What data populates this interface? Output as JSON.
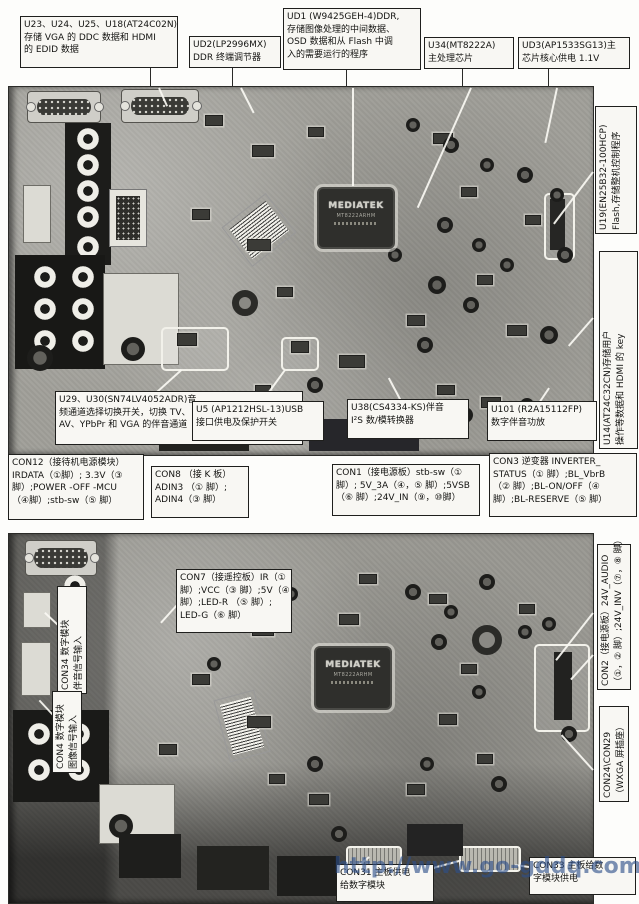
{
  "chip": {
    "logo": "MEDIATEK",
    "line1": "MT8222ARHM"
  },
  "watermark": {
    "text": "http://www.go-gddq.com",
    "color": "#2d4f8a"
  },
  "callouts": {
    "u23": {
      "lines": [
        "U23、U24、U25、U18(AT24C02N)",
        "存储 VGA 的 DDC 数据和 HDMI",
        "的 EDID 数据"
      ]
    },
    "ud2": {
      "lines": [
        "UD2(LP2996MX)",
        "DDR 终端调节器"
      ]
    },
    "ud1": {
      "lines": [
        "UD1 (W9425GEH-4)DDR,",
        "存储图像处理的中间数据、",
        "OSD 数据和从 Flash 中调",
        "入的需要运行的程序"
      ]
    },
    "u34": {
      "lines": [
        "U34(MT8222A)",
        "主处理芯片"
      ]
    },
    "ud3": {
      "lines": [
        "UD3(AP1533SG13)主",
        "芯片核心供电 1.1V"
      ]
    },
    "u19": {
      "lines": [
        "U19(EN25B32-100HCP)",
        "Flash,存储整机控制程序"
      ]
    },
    "u14": {
      "lines": [
        "U14(AT24C32CN)存储用户",
        "操作等数据和 HDMI 的 key"
      ]
    },
    "u29": {
      "lines": [
        "U29、U30(SN74LV4052ADR)音",
        "频通道选择切换开关，切换 TV、",
        "AV、YPbPr 和 VGA 的伴音通道"
      ]
    },
    "u5": {
      "lines": [
        "U5 (AP1212HSL-13)USB",
        "接口供电及保护开关"
      ]
    },
    "u38": {
      "lines": [
        "U38(CS4334-KS)伴音",
        "I²S 数/模转换器"
      ]
    },
    "u101": {
      "lines": [
        "U101 (R2A15112FP)",
        "数字伴音功放"
      ]
    },
    "con12": {
      "lines": [
        "CON12（接待机电源模块）",
        "IRDATA（①脚）; 3.3V（③",
        "脚）;POWER -OFF -MCU",
        "（④脚）;stb-sw（⑤ 脚）"
      ]
    },
    "con8": {
      "lines": [
        "CON8 （接 K 板）",
        "ADIN3 （① 脚）;",
        "ADIN4（③ 脚）"
      ]
    },
    "con1": {
      "lines": [
        "CON1（接电源板）stb-sw（①",
        "脚）; 5V_3A（④，⑤ 脚）;5VSB",
        "（⑥ 脚）;24V_IN（⑨，⑩脚）"
      ]
    },
    "con3": {
      "lines": [
        "CON3 逆变器 INVERTER_",
        "STATUS（① 脚）;BL_VbrB",
        "（② 脚）;BL-ON/OFF（④",
        "脚）;BL-RESERVE（⑤ 脚）"
      ]
    },
    "con34": {
      "lines": [
        "CON34 数字模块",
        "伴音信号输入"
      ]
    },
    "con4": {
      "lines": [
        "CON4 数字模块",
        "图像信号输入"
      ]
    },
    "con7": {
      "lines": [
        "CON7（接遥控板）IR（①",
        "脚）;VCC（③ 脚）;5V（④",
        "脚）;LED-R （⑤ 脚）;",
        "LED-G（⑥ 脚）"
      ]
    },
    "con2": {
      "lines": [
        "CON2（接电源板）24V_AUDIO",
        "（①，② 脚）;24V_INV（⑦，⑧ 脚）"
      ]
    },
    "con24": {
      "lines": [
        "CON24\\CON29",
        "（WXGA 屏插座）"
      ]
    },
    "con31": {
      "lines": [
        "CON31 主板供电",
        "给数字模块"
      ]
    },
    "con33": {
      "lines": [
        "CON33 主板给数",
        "字模块供电"
      ]
    }
  }
}
